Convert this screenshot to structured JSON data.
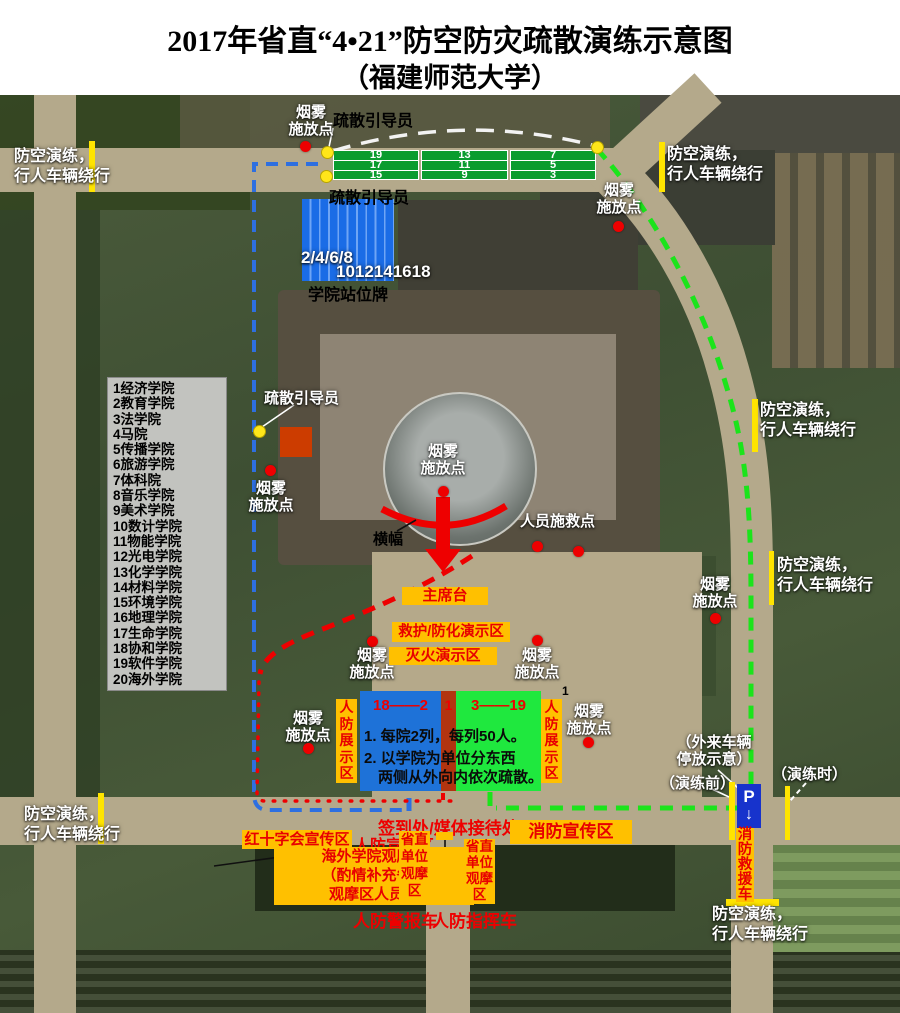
{
  "title": {
    "line1": "2017年省直“4•21”防空防灾疏散演练示意图",
    "line2": "（福建师范大学）"
  },
  "legend": {
    "smoke_line1": "烟雾",
    "smoke_line2": "施放点",
    "guide": "疏散引导员",
    "detour_line1": "防空演练，",
    "detour_line2": "行人车辆绕行",
    "rescue_point": "人员施救点",
    "banner": "横幅"
  },
  "assembly": {
    "columns": [
      {
        "rows": [
          "19",
          "17",
          "15"
        ]
      },
      {
        "rows": [
          "13",
          "11",
          "9"
        ]
      },
      {
        "rows": [
          "7",
          "5",
          "3"
        ]
      }
    ],
    "station_sign": {
      "front_numbers": "2/4/6/8",
      "back_numbers": "1012141618",
      "caption": "学院站位牌"
    }
  },
  "colleges": [
    "1经济学院",
    "2教育学院",
    "3法学院",
    "4马院",
    "5传播学院",
    "6旅游学院",
    "7体科院",
    "8音乐学院",
    "9美术学院",
    "10数计学院",
    "11物能学院",
    "12光电学院",
    "13化学学院",
    "14材料学院",
    "15环境学院",
    "16地理学院",
    "17生命学院",
    "18协和学院",
    "19软件学院",
    "20海外学院"
  ],
  "stage": {
    "podium": "主席台",
    "aid_demo": "救护/防化演示区",
    "fire_demo": "灭火演示区"
  },
  "formation": {
    "west_range": "18——2",
    "center_number": "1",
    "east_range": "3——19",
    "note1": "1. 每院2列，每列50人。",
    "note2": "2. 以学院为单位分东西",
    "note3": "两侧从外向内依次疏散。",
    "display_zone": "人防展示区",
    "corner_marker": "1"
  },
  "bottom": {
    "check_in": "签到处/媒体接待处",
    "red_cross_zone": "红十字会宣传区",
    "cd_pub_zone": "人防宣传区",
    "fire_pub_zone": "消防宣传区",
    "overseas_line1": "海外学院观摩区",
    "overseas_line2": "（酌情补充省直",
    "overseas_line3": "观摩区人员）",
    "provincial_stand": "省直单位观摩区",
    "alarm_vehicle": "人防警报车",
    "command_vehicle": "人防指挥车",
    "fire_rescue_vehicle": "消防救援车",
    "parking": "P",
    "parking_arrow": "↓",
    "parking_note_line1": "（外来车辆",
    "parking_note_line2": "停放示意）",
    "before_drill": "（演练前）",
    "during_drill": "（演练时）"
  },
  "colors": {
    "closure_bar_yellow": "#ffe400",
    "label_yellow": "#ffc000",
    "marker_red": "#ee0000",
    "route_blue": "#2e6fe0",
    "route_green": "#1be41b",
    "west_box_blue": "#1e72d8",
    "east_box_green": "#1fe83e",
    "center_strip_brown": "#b23410"
  }
}
